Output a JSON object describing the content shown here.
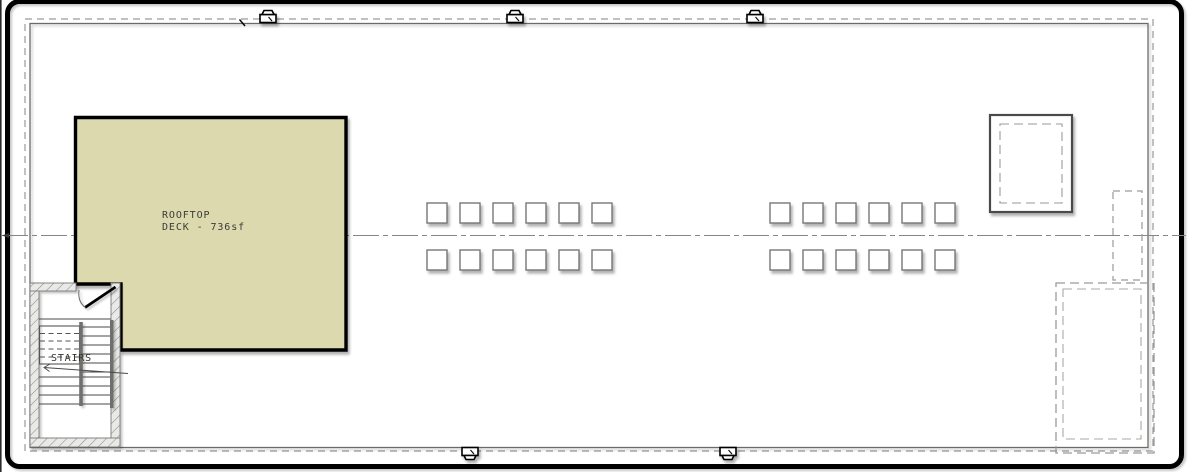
{
  "drawing": {
    "type": "architectural-roof-plan",
    "deck": {
      "label_line1": "ROOFTOP",
      "label_line2": "DECK - 736sf",
      "area_sf": 736,
      "fill_color": "#dbd9ad"
    },
    "stairs": {
      "label": "STAIRS"
    },
    "skylights": {
      "rows": 2,
      "columns_per_group": 6,
      "groups": [
        {
          "side": "left"
        },
        {
          "side": "right"
        }
      ],
      "square_size_px": 20
    },
    "vents": {
      "top_count": 3,
      "bottom_count": 2,
      "icon": "roof-vent-icon"
    },
    "colors": {
      "outline": "#000000",
      "deck_fill": "#dbd9ad",
      "dashed_line": "#9a9a9a",
      "wall_line": "#666666",
      "tread_line": "#4a4a4a",
      "background": "#ffffff"
    }
  }
}
